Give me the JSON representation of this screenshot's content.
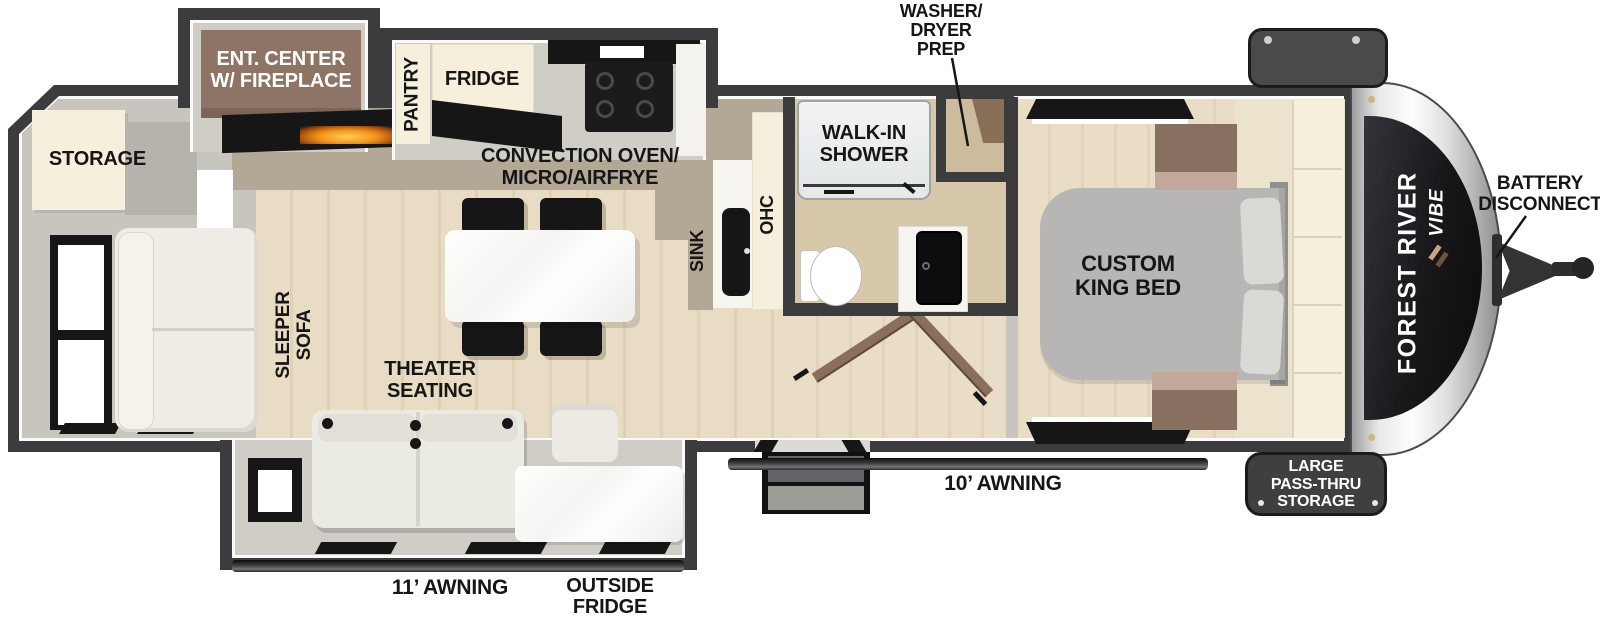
{
  "brand": {
    "line1": "FOREST RIVER",
    "line2": "VIBE"
  },
  "areas": {
    "storage": "STORAGE",
    "ent_center": {
      "line1": "ENT. CENTER",
      "line2": "W/ FIREPLACE"
    },
    "pantry": "PANTRY",
    "fridge": "FRIDGE",
    "convection": {
      "line1": "CONVECTION OVEN/",
      "line2": "MICRO/AIRFRYE"
    },
    "sink": "SINK",
    "ohc": "OHC",
    "sleeper_sofa": {
      "line1": "SLEEPER",
      "line2": "SOFA"
    },
    "theater_seating": {
      "line1": "THEATER",
      "line2": "SEATING"
    },
    "walk_in_shower": {
      "line1": "WALK-IN",
      "line2": "SHOWER"
    },
    "washer_dryer_prep": {
      "line1": "WASHER/",
      "line2": "DRYER",
      "line3": "PREP"
    },
    "custom_king_bed": {
      "line1": "CUSTOM",
      "line2": "KING BED"
    }
  },
  "exterior": {
    "battery_disconnect": {
      "line1": "BATTERY",
      "line2": "DISCONNECT"
    },
    "pass_thru_storage": {
      "line1": "LARGE",
      "line2": "PASS-THRU",
      "line3": "STORAGE"
    },
    "awning_rear": "11’ AWNING",
    "awning_front": "10’ AWNING",
    "outside_fridge": {
      "line1": "OUTSIDE",
      "line2": "FRIDGE"
    }
  },
  "colors": {
    "wall": "#3c3c3e",
    "wood_floor": "#e8dcc4",
    "kitchen_tile": "#b3a795",
    "cream_cabinet": "#f6efdc",
    "ent_center_brown": "#8d7465",
    "bed_gray": "#b7b6b4",
    "nightstand_brown": "#87705f",
    "flame_orange": "#f29018",
    "badge_dark": "#3f3f41",
    "white_furniture": "#eeece4"
  }
}
